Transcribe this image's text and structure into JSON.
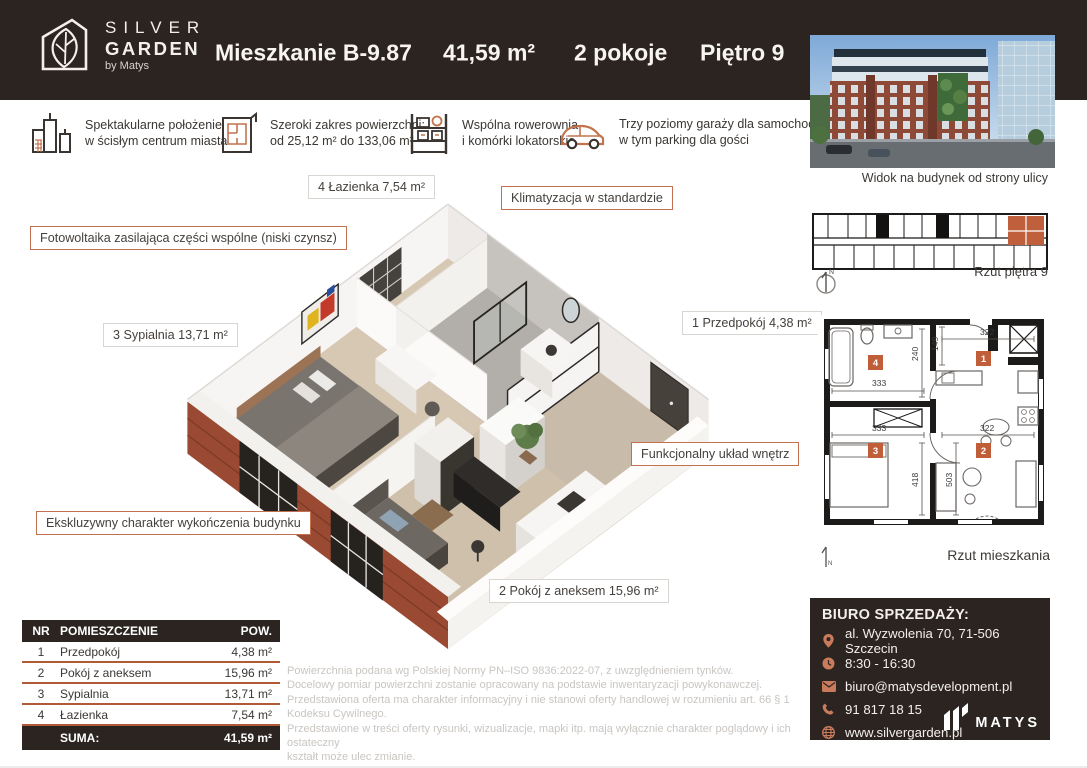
{
  "colors": {
    "dark": "#2b2421",
    "accent": "#c1714f",
    "table_line": "#b05a38",
    "brick": "#9a4a33"
  },
  "header": {
    "logo": {
      "line1": "SILVER",
      "line2": "GARDEN",
      "line3": "by Matys"
    },
    "title": "Mieszkanie B-9.87",
    "area": "41,59 m²",
    "rooms": "2 pokoje",
    "floor": "Piętro 9"
  },
  "features": [
    {
      "icon": "city-icon",
      "line1": "Spektakularne położenie",
      "line2": "w ścisłym centrum miasta"
    },
    {
      "icon": "floorplan-icon",
      "line1": "Szeroki zakres powierzchni:",
      "line2": "od 25,12 m² do 133,06 m²"
    },
    {
      "icon": "storage-icon",
      "line1": "Wspólna rowerownia",
      "line2": "i komórki lokatorskie"
    },
    {
      "icon": "car-icon",
      "line1": "Trzy poziomy garaży dla samochodów,",
      "line2": "w tym parking dla gości"
    }
  ],
  "plan_labels": {
    "bathroom": "4 Łazienka 7,54 m²",
    "ac": "Klimatyzacja w standardzie",
    "pv": "Fotowoltaika zasilająca części wspólne (niski czynsz)",
    "bedroom": "3 Sypialnia 13,71 m²",
    "hall": "1 Przedpokój 4,38 m²",
    "functional": "Funkcjonalny układ wnętrz",
    "exclusive": "Ekskluzywny charakter wykończenia budynku",
    "living": "2 Pokój z aneksem 15,96 m²"
  },
  "sidebar": {
    "photo_caption": "Widok na budynek od strony ulicy",
    "floor_plan_caption": "Rzut piętra 9",
    "unit_plan_caption": "Rzut mieszkania",
    "compass_n": "N"
  },
  "unit_plan": {
    "dims": {
      "bath_w": "333",
      "bath_h": "240",
      "hall_h": "149",
      "hall_w": "322",
      "bed_w": "333",
      "bed_h": "418",
      "living_w": "322",
      "living_h": "503"
    },
    "numbers": {
      "hall": "1",
      "living": "2",
      "bedroom": "3",
      "bath": "4"
    }
  },
  "office": {
    "title": "BIURO SPRZEDAŻY:",
    "address": "al. Wyzwolenia 70, 71-506 Szczecin",
    "hours": "8:30 - 16:30",
    "email": "biuro@matysdevelopment.pl",
    "phone": "91 817 18 15",
    "website": "www.silvergarden.pl",
    "brand": "MATYS"
  },
  "rooms_table": {
    "headers": [
      "NR",
      "POMIESZCZENIE",
      "POW."
    ],
    "rows": [
      {
        "nr": "1",
        "name": "Przedpokój",
        "area": "4,38 m²"
      },
      {
        "nr": "2",
        "name": "Pokój z aneksem",
        "area": "15,96 m²"
      },
      {
        "nr": "3",
        "name": "Sypialnia",
        "area": "13,71 m²"
      },
      {
        "nr": "4",
        "name": "Łazienka",
        "area": "7,54 m²"
      }
    ],
    "total_label": "SUMA:",
    "total_value": "41,59 m²"
  },
  "disclaimer": {
    "lines": [
      "Powierzchnia podana wg Polskiej Normy PN–ISO 9836:2022-07, z uwzględnieniem tynków.",
      "Docelowy pomiar powierzchni zostanie opracowany na podstawie inwentaryzacji powykonawczej.",
      "Przedstawiona oferta ma charakter informacyjny i nie stanowi oferty handlowej w rozumieniu art. 66 § 1 Kodeksu Cywilnego.",
      "Przedstawione w treści oferty rysunki, wizualizacje, mapki itp. mają wyłącznie charakter poglądowy i ich ostateczny",
      "kształt może ulec zmianie."
    ]
  }
}
